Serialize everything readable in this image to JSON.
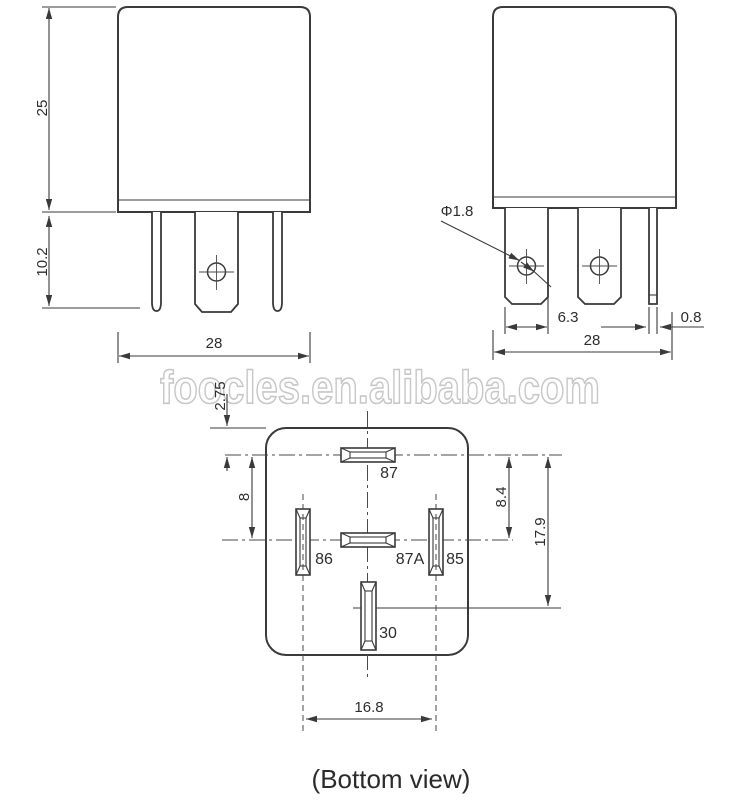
{
  "watermark": "foocles.en.alibaba.com",
  "caption": "(Bottom view)",
  "front_view": {
    "body_height": "25",
    "pin_length": "10.2",
    "body_width": "28"
  },
  "side_view": {
    "hole_diameter": "Φ1.8",
    "blade_width": "6.3",
    "thin_pin_width": "0.8",
    "body_width": "28"
  },
  "bottom_view": {
    "pin87_offset": "2.75",
    "row_gap_left": "8",
    "row_gap_right": "8.4",
    "pin_span_vertical": "17.9",
    "pin_span_horizontal": "16.8",
    "pin_labels": {
      "p87": "87",
      "p86": "86",
      "p87a": "87A",
      "p85": "85",
      "p30": "30"
    }
  },
  "colors": {
    "line": "#3a3a3a",
    "text": "#2d2d2d",
    "watermark": "#c7c7c7",
    "background": "#ffffff"
  }
}
